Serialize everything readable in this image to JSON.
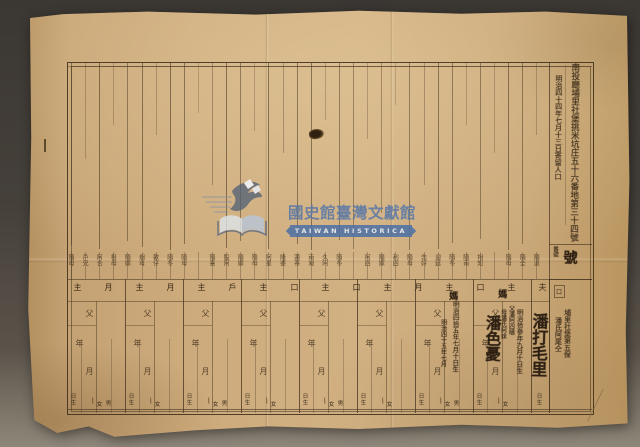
{
  "watermark": {
    "title": "國史館臺灣文獻館",
    "subtitle": "TAIWAN HISTORICA",
    "brand_blue": "#4e71a4",
    "text_blue": "#5b79a8"
  },
  "header": {
    "address_line": "南投廳埔里社堡挑米坑庄五十六番地第三十四號",
    "date_line": "明治四十四年七月十三日寄留人口",
    "number_label": "番號",
    "number_value": "號",
    "small_box_mark": "口"
  },
  "relationship_labels": [
    "隨母",
    "戶兄",
    "阿合",
    "祖母",
    "隨嫁",
    "烟母",
    "歡仔",
    "隨冬",
    "隨母",
    "",
    "隨喜",
    "股阿",
    "隨嫁",
    "隨母",
    "阿星",
    "隆婆",
    "蓮茶",
    "南昶",
    "久阿",
    "隨冬",
    "",
    "阿四",
    "隨嫁",
    "利四",
    "隨母",
    "念好",
    "迎延",
    "隨冬",
    "隨南",
    "相知",
    "",
    "隨母",
    "隨全",
    "隨退"
  ],
  "row_markers": [
    "主",
    "月",
    "主",
    "月",
    "主",
    "戶",
    "主",
    "口",
    "主",
    "口",
    "主",
    "月",
    "主",
    "口",
    "主",
    "夫"
  ],
  "printed_fields": {
    "father": "父",
    "year": "年",
    "month": "月",
    "day_born": "日生",
    "female": "女",
    "male": "男",
    "slash": "∕"
  },
  "entries": {
    "head_name": "潘打毛里",
    "head_birth": "明治拾參年九月十日生",
    "second_name": "潘色憂",
    "father_note": "父潘阿四嗹",
    "mother_note": "母潘氏阿妹",
    "date_note": "明治四拾五年七月十日生",
    "date_note_2": "明治四十五年七月",
    "kin_mark_1": "媽",
    "kin_mark_2": "媽",
    "right_note_1": "埔里社堡第五保",
    "right_note_2": "潘氏阿尾仝"
  },
  "colors": {
    "paper": "#c9a77a",
    "ink": "#2d2013",
    "rule_line": "#4d3b24",
    "backdrop": "#45403a"
  }
}
